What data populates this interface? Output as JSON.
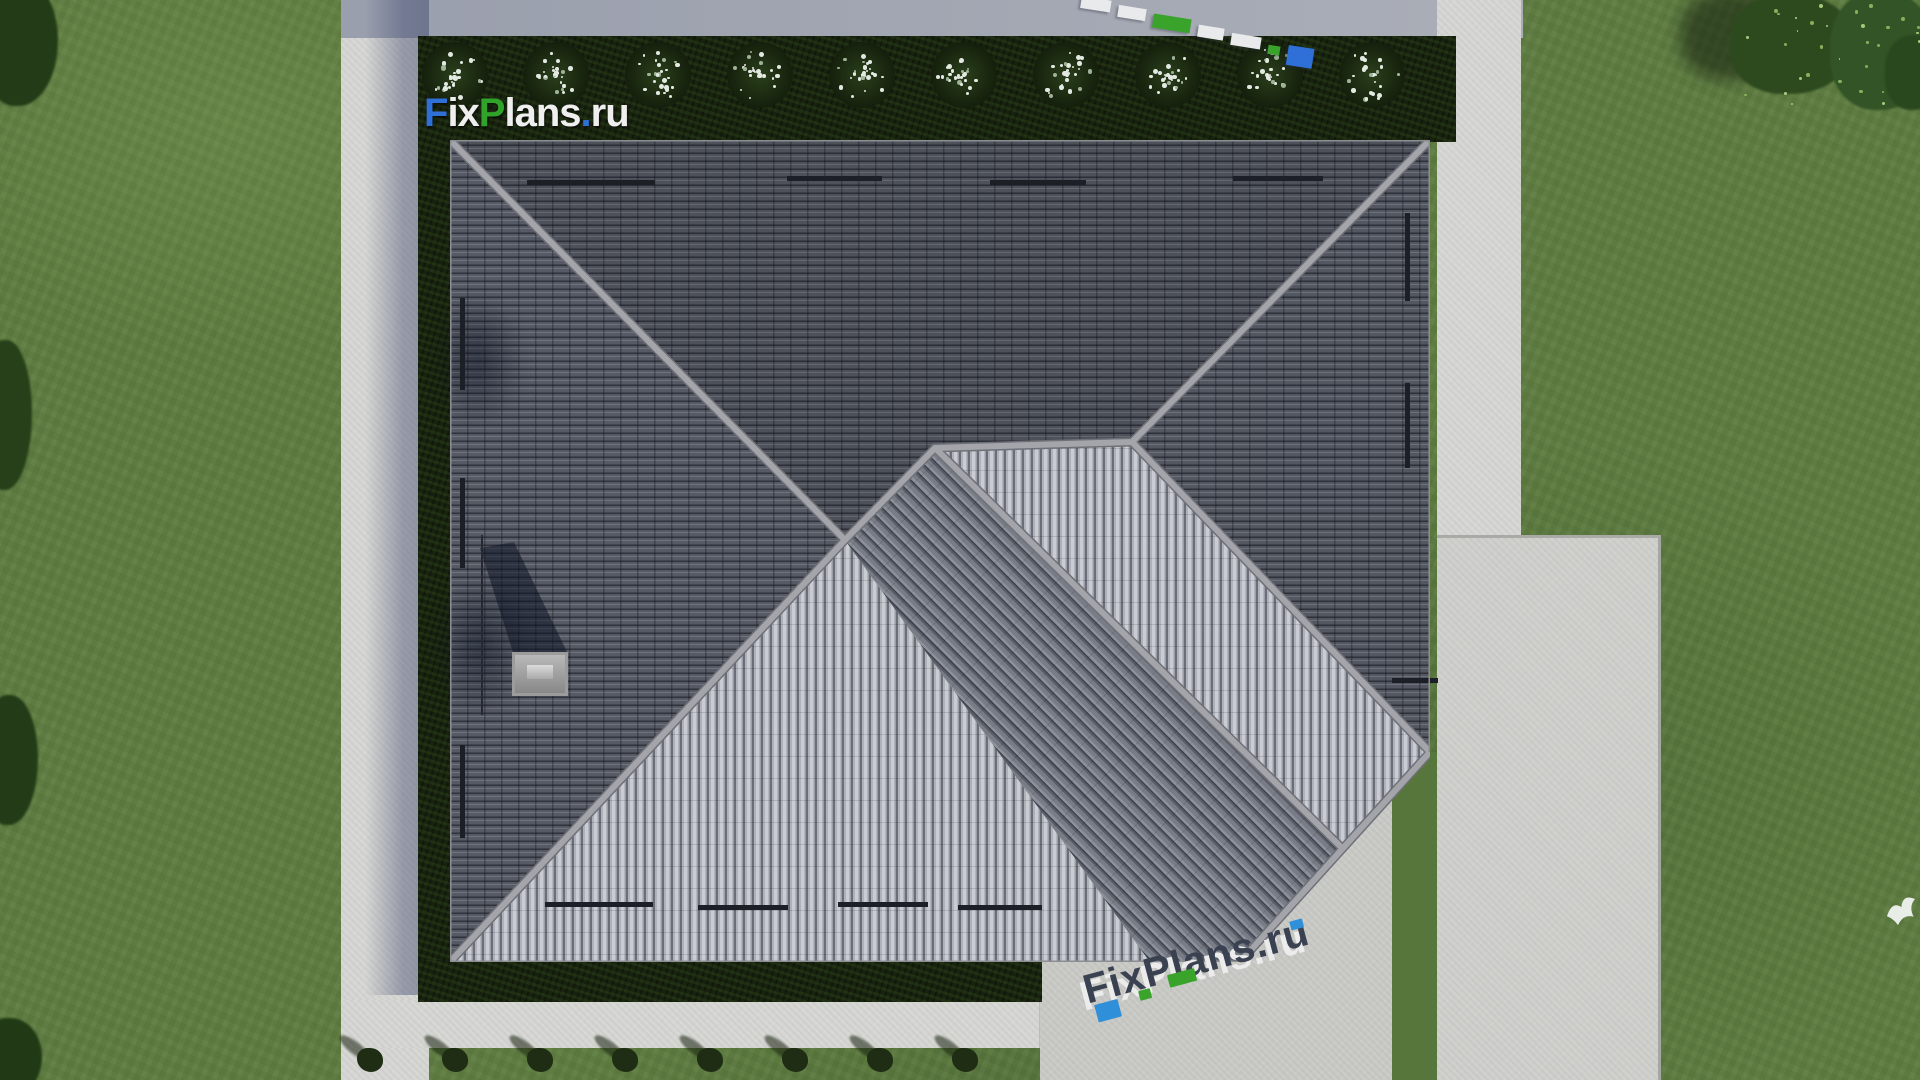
{
  "scene": {
    "description": "Aerial top-down 3D render of a hip-roofed house with lawn, hedges, walkways and driveway",
    "branding": {
      "logo": {
        "full_text": "FixPlans.ru",
        "part_f": "F",
        "part_ix": "ix",
        "part_p": "P",
        "part_lans": "lans",
        "part_dot": ".",
        "part_ru": "ru",
        "blue": "#2e6fd8",
        "green": "#2fa32a",
        "white": "#efefef"
      },
      "watermark_bottom_text": "FixPlans.ru",
      "watermark_top_text": "FixPlans.ru"
    },
    "palette": {
      "grass": "#5e7c41",
      "grass_dark": "#4f6b35",
      "pavement": "#d6d6d3",
      "pavement_shadow": "#8e95a9",
      "hedge": "#18230f",
      "roof_dark": "#565a64",
      "roof_bright": "#c7cad1",
      "roof_mid": "#6e727c",
      "ridge": "#a0a2a7",
      "driveway": "#cfd0cc",
      "gravel": "#b7b8b4",
      "flower_white": "#e3e9e2",
      "conifer": "#1e2d13"
    },
    "objects": {
      "flower_bushes": {
        "count": 10,
        "centers_x": [
          455,
          556,
          658,
          760,
          862,
          964,
          1066,
          1168,
          1270,
          1372
        ],
        "center_y": 75,
        "radius": 33
      },
      "conifers": {
        "count": 8,
        "centers_x": [
          370,
          455,
          540,
          625,
          710,
          795,
          880,
          965
        ],
        "center_y": 1058
      },
      "tree_speckles": {
        "count": 34
      },
      "bird": {
        "x": 1883,
        "y": 893
      }
    }
  }
}
